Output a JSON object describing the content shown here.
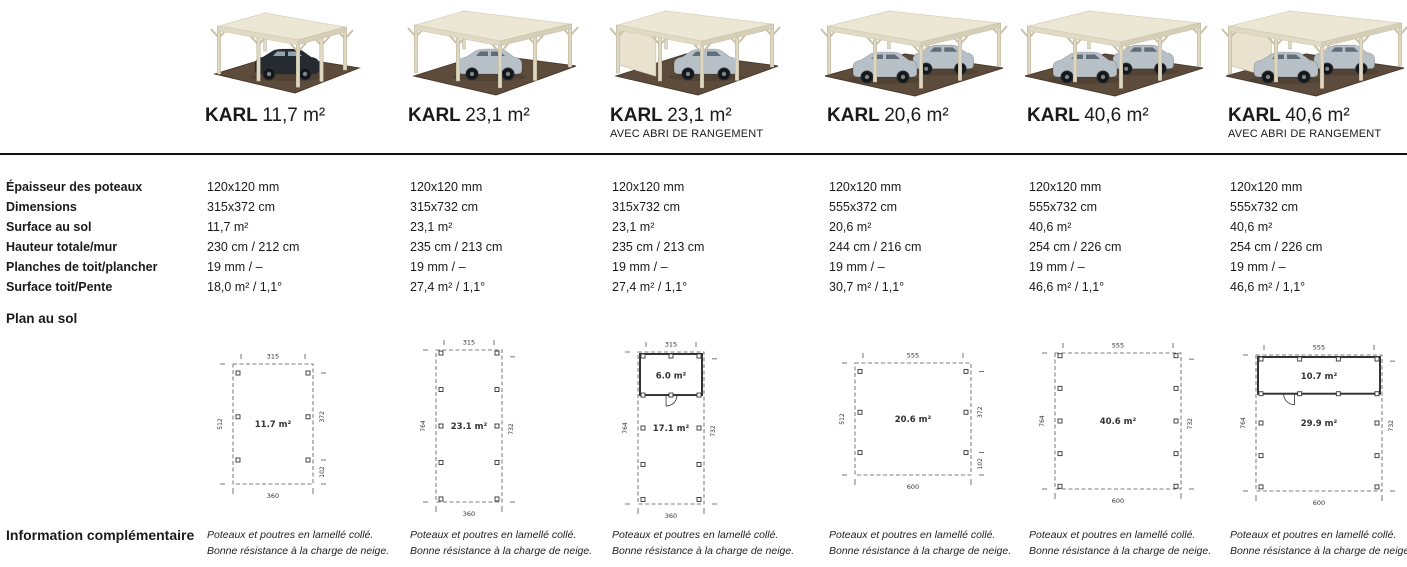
{
  "section_labels": {
    "plan": "Plan au sol",
    "info": "Information complémentaire"
  },
  "spec_labels": [
    "Épaisseur des poteaux",
    "Dimensions",
    "Surface au sol",
    "Hauteur totale/mur",
    "Planches de toit/plancher",
    "Surface toit/Pente"
  ],
  "colors": {
    "text": "#1a1a1a",
    "divider": "#111111",
    "roof": "#ece7d4",
    "wood": "#ded7c1",
    "gravel": "#5d4c3c",
    "car_dark": "#262b31",
    "car_silver": "#b7bfc7",
    "plan_line": "#555555"
  },
  "products": [
    {
      "name": "KARL",
      "size": "11,7 m²",
      "subtitle": "",
      "specs": [
        "120x120 mm",
        "315x372 cm",
        "11,7 m²",
        "230 cm / 212 cm",
        "19 mm / –",
        "18,0 m² / 1,1°"
      ],
      "plan": {
        "area": "11.7 m²",
        "dim_top": "315",
        "dim_bottom": "360",
        "dim_left": "512",
        "dim_right": "372",
        "dim_right_b": "102",
        "posts": 3,
        "rect_w": 80,
        "rect_h": 120,
        "shed": null
      },
      "image": {
        "kind": "carport-photo",
        "cars": [
          "dark"
        ],
        "wide": false,
        "long": false,
        "shed": false
      },
      "info": [
        "Poteaux et poutres en lamellé collé.",
        "Bonne résistance à la charge de neige."
      ]
    },
    {
      "name": "KARL",
      "size": "23,1 m²",
      "subtitle": "",
      "specs": [
        "120x120 mm",
        "315x732 cm",
        "23,1 m²",
        "235 cm / 213 cm",
        "19 mm / –",
        "27,4 m² / 1,1°"
      ],
      "plan": {
        "area": "23.1 m²",
        "dim_top": "315",
        "dim_bottom": "360",
        "dim_left": "764",
        "dim_right": "732",
        "dim_right_b": null,
        "posts": 5,
        "rect_w": 66,
        "rect_h": 152,
        "shed": null
      },
      "image": {
        "kind": "carport-photo",
        "cars": [
          "silver"
        ],
        "wide": false,
        "long": true,
        "shed": false
      },
      "info": [
        "Poteaux et poutres en lamellé collé.",
        "Bonne résistance à la charge de neige."
      ]
    },
    {
      "name": "KARL",
      "size": "23,1 m²",
      "subtitle": "AVEC ABRI DE RANGEMENT",
      "specs": [
        "120x120 mm",
        "315x732 cm",
        "23,1 m²",
        "235 cm / 213 cm",
        "19 mm / –",
        "27,4 m² / 1,1°"
      ],
      "plan": {
        "area": "17.1 m²",
        "dim_top": "315",
        "dim_bottom": "360",
        "dim_left": "764",
        "dim_right": "732",
        "dim_right_b": null,
        "posts": 5,
        "rect_w": 66,
        "rect_h": 152,
        "shed": {
          "area": "6.0 m²",
          "door_x": 0.42,
          "door_dir": 1,
          "posts_across": 3
        }
      },
      "image": {
        "kind": "carport-photo",
        "cars": [
          "silver"
        ],
        "wide": false,
        "long": true,
        "shed": true
      },
      "info": [
        "Poteaux et poutres en lamellé collé.",
        "Bonne résistance à la charge de neige."
      ]
    },
    {
      "name": "KARL",
      "size": "20,6 m²",
      "subtitle": "",
      "specs": [
        "120x120 mm",
        "555x372 cm",
        "20,6 m²",
        "244 cm / 216 cm",
        "19 mm / –",
        "30,7 m² / 1,1°"
      ],
      "plan": {
        "area": "20.6 m²",
        "dim_top": "555",
        "dim_bottom": "600",
        "dim_left": "512",
        "dim_right": "372",
        "dim_right_b": "102",
        "posts": 3,
        "rect_w": 116,
        "rect_h": 112,
        "shed": null
      },
      "image": {
        "kind": "carport-photo",
        "cars": [
          "silver",
          "silver"
        ],
        "wide": true,
        "long": false,
        "shed": false
      },
      "info": [
        "Poteaux et poutres en lamellé collé.",
        "Bonne résistance à la charge de neige."
      ]
    },
    {
      "name": "KARL",
      "size": "40,6 m²",
      "subtitle": "",
      "specs": [
        "120x120 mm",
        "555x732 cm",
        "40,6 m²",
        "254 cm / 226 cm",
        "19 mm / –",
        "46,6 m² / 1,1°"
      ],
      "plan": {
        "area": "40.6 m²",
        "dim_top": "555",
        "dim_bottom": "600",
        "dim_left": "764",
        "dim_right": "732",
        "dim_right_b": null,
        "posts": 5,
        "rect_w": 126,
        "rect_h": 136,
        "shed": null
      },
      "image": {
        "kind": "carport-photo",
        "cars": [
          "silver",
          "silver"
        ],
        "wide": true,
        "long": true,
        "shed": false
      },
      "info": [
        "Poteaux et poutres en lamellé collé.",
        "Bonne résistance à la charge de neige."
      ]
    },
    {
      "name": "KARL",
      "size": "40,6 m²",
      "subtitle": "AVEC ABRI DE RANGEMENT",
      "specs": [
        "120x120 mm",
        "555x732 cm",
        "40,6 m²",
        "254 cm / 226 cm",
        "19 mm / –",
        "46,6 m² / 1,1°"
      ],
      "plan": {
        "area": "29.9 m²",
        "dim_top": "555",
        "dim_bottom": "600",
        "dim_left": "764",
        "dim_right": "732",
        "dim_right_b": null,
        "posts": 5,
        "rect_w": 126,
        "rect_h": 136,
        "shed": {
          "area": "10.7 m²",
          "door_x": 0.3,
          "door_dir": -1,
          "posts_across": 4
        }
      },
      "image": {
        "kind": "carport-photo",
        "cars": [
          "silver",
          "silver"
        ],
        "wide": true,
        "long": true,
        "shed": true
      },
      "info": [
        "Poteaux et poutres en lamellé collé.",
        "Bonne résistance à la charge de neige."
      ]
    }
  ]
}
